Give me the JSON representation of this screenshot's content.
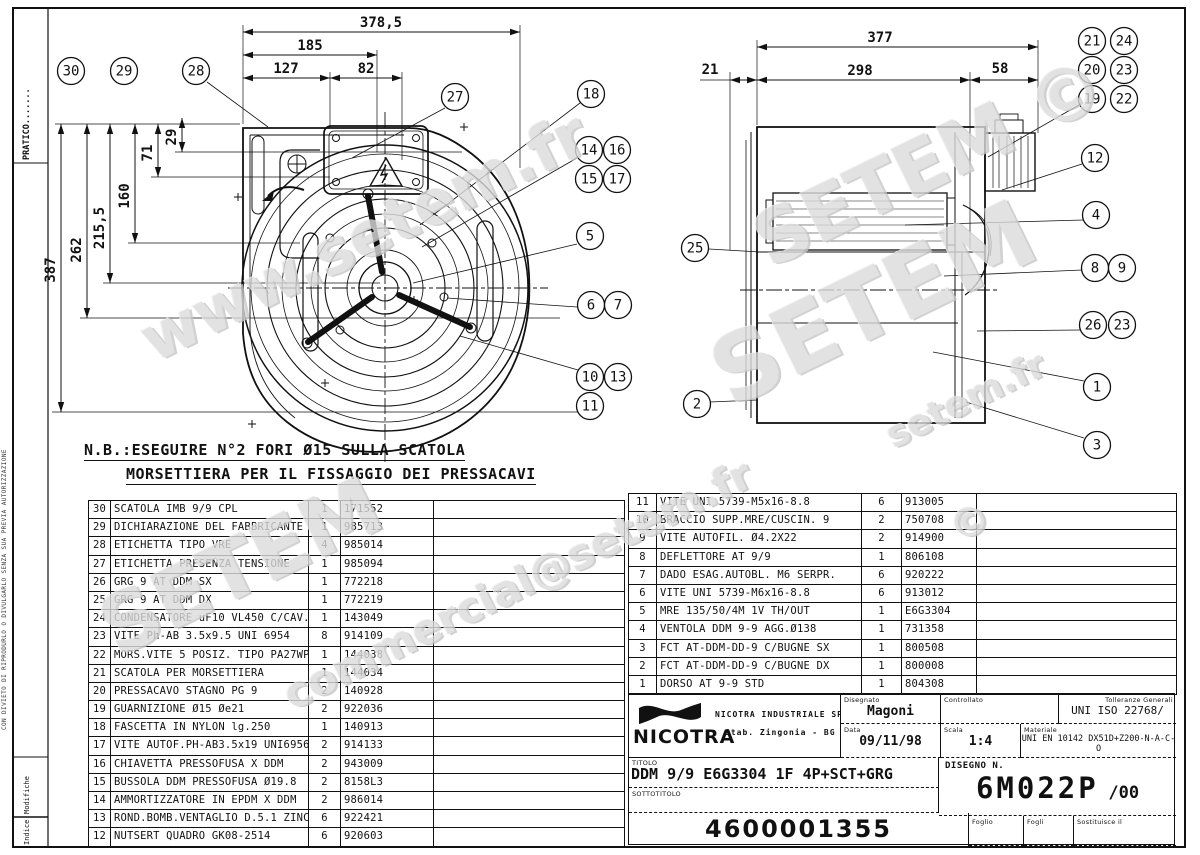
{
  "note": {
    "line1": "N.B.:ESEGUIRE N°2 FORI Ø15 SULLA SCATOLA",
    "line2": "MORSETTIERA PER IL FISSAGGIO DEI PRESSACAVI"
  },
  "margin": {
    "pratico": "PRATICO.......",
    "copyright": "CON DIVIETO DI RIPRODURLO O DIVULGARLO SENZA SUA PREVIA AUTORIZZAZIONE",
    "modifiche": "Modifiche",
    "indice": "Indice"
  },
  "dims": {
    "front_total": "378,5",
    "front_a": "185",
    "front_b": "127",
    "front_c": "82",
    "front_h_total": "387",
    "front_h1": "262",
    "front_h2": "215,5",
    "front_h3": "160",
    "front_h4": "71",
    "front_h5": "29",
    "side_total": "377",
    "side_a": "298",
    "side_b": "58",
    "side_c": "21"
  },
  "balloons": [
    "30",
    "29",
    "28",
    "27",
    "18",
    "14",
    "16",
    "15",
    "17",
    "5",
    "6",
    "7",
    "10",
    "13",
    "11",
    "21",
    "24",
    "20",
    "23",
    "19",
    "22",
    "12",
    "4",
    "8",
    "9",
    "26",
    "23",
    "1",
    "3",
    "25",
    "2"
  ],
  "parts_left": {
    "rows": [
      {
        "no": "30",
        "desc": "SCATOLA IMB 9/9 CPL",
        "qty": "1",
        "code": "171552"
      },
      {
        "no": "29",
        "desc": "DICHIARAZIONE DEL FABBRICANTE",
        "qty": "1",
        "code": "985713"
      },
      {
        "no": "28",
        "desc": "ETICHETTA TIPO VRE",
        "qty": "4",
        "code": "985014"
      },
      {
        "no": "27",
        "desc": "ETICHETTA PRESENZA TENSIONE",
        "qty": "1",
        "code": "985094"
      },
      {
        "no": "26",
        "desc": "GRG 9 AT DDM SX",
        "qty": "1",
        "code": "772218"
      },
      {
        "no": "25",
        "desc": "GRG 9 AT DDM DX",
        "qty": "1",
        "code": "772219"
      },
      {
        "no": "24",
        "desc": "CONDENSATORE uF10 VL450 C/CAV.",
        "qty": "1",
        "code": "143049"
      },
      {
        "no": "23",
        "desc": "VITE Ph-AB 3.5x9.5 UNI 6954",
        "qty": "8",
        "code": "914109"
      },
      {
        "no": "22",
        "desc": "MORS.VITE 5 POSIZ. TIPO PA27WP",
        "qty": "1",
        "code": "144038"
      },
      {
        "no": "21",
        "desc": "SCATOLA PER MORSETTIERA",
        "qty": "1",
        "code": "144034"
      },
      {
        "no": "20",
        "desc": "PRESSACAVO STAGNO PG 9",
        "qty": "2",
        "code": "140928"
      },
      {
        "no": "19",
        "desc": "GUARNIZIONE Ø15 Øe21",
        "qty": "2",
        "code": "922036"
      },
      {
        "no": "18",
        "desc": "FASCETTA IN NYLON lg.250",
        "qty": "1",
        "code": "140913"
      },
      {
        "no": "17",
        "desc": "VITE AUTOF.PH-AB3.5x19 UNI6956",
        "qty": "2",
        "code": "914133"
      },
      {
        "no": "16",
        "desc": "CHIAVETTA PRESSOFUSA X DDM",
        "qty": "2",
        "code": "943009"
      },
      {
        "no": "15",
        "desc": "BUSSOLA DDM PRESSOFUSA Ø19.8",
        "qty": "2",
        "code": "8158L3"
      },
      {
        "no": "14",
        "desc": "AMMORTIZZATORE IN EPDM X DDM",
        "qty": "2",
        "code": "986014"
      },
      {
        "no": "13",
        "desc": "ROND.BOMB.VENTAGLIO D.5.1 ZINC",
        "qty": "6",
        "code": "922421"
      },
      {
        "no": "12",
        "desc": "NUTSERT QUADRO GK08-2514",
        "qty": "6",
        "code": "920603"
      }
    ]
  },
  "parts_right": {
    "rows": [
      {
        "no": "11",
        "desc": "VITE UNI 5739-M5x16-8.8",
        "qty": "6",
        "code": "913005"
      },
      {
        "no": "10",
        "desc": "BRACCIO SUPP.MRE/CUSCIN. 9",
        "qty": "2",
        "code": "750708"
      },
      {
        "no": "9",
        "desc": "VITE AUTOFIL. Ø4.2X22",
        "qty": "2",
        "code": "914900"
      },
      {
        "no": "8",
        "desc": "DEFLETTORE AT 9/9",
        "qty": "1",
        "code": "806108"
      },
      {
        "no": "7",
        "desc": "DADO ESAG.AUTOBL. M6 SERPR.",
        "qty": "6",
        "code": "920222"
      },
      {
        "no": "6",
        "desc": "VITE UNI 5739-M6x16-8.8",
        "qty": "6",
        "code": "913012"
      },
      {
        "no": "5",
        "desc": "MRE 135/50/4M 1V TH/OUT",
        "qty": "1",
        "code": "E6G3304"
      },
      {
        "no": "4",
        "desc": "VENTOLA DDM 9-9 AGG.Ø138",
        "qty": "1",
        "code": "731358"
      },
      {
        "no": "3",
        "desc": "FCT AT-DDM-DD-9 C/BUGNE SX",
        "qty": "1",
        "code": "800508"
      },
      {
        "no": "2",
        "desc": "FCT AT-DDM-DD-9 C/BUGNE DX",
        "qty": "1",
        "code": "800008"
      },
      {
        "no": "1",
        "desc": "DORSO AT 9-9 STD",
        "qty": "1",
        "code": "804308"
      }
    ]
  },
  "title_block": {
    "company": "NICOTRA",
    "company_full": "NICOTRA INDUSTRIALE SPA",
    "plant": "Stab. Zingonia - BG",
    "labels": {
      "disegnato": "Disegnato",
      "controllato": "Controllato",
      "tolleranze": "Tolleranze Generali",
      "data": "Data",
      "scala": "Scala",
      "materiale": "Materiale",
      "titolo": "TITOLO",
      "sottotitolo": "SOTTOTITOLO",
      "disegno_n": "DISEGNO N.",
      "foglio": "Foglio",
      "fogli": "Fogli",
      "sostituisce": "Sostituisce il"
    },
    "values": {
      "disegnato": "Magoni",
      "data": "09/11/98",
      "scala": "1:4",
      "tolleranze": "UNI ISO 22768/",
      "materiale": "UNI EN 10142 DX51D+Z200-N-A-C-O",
      "titolo": "DDM 9/9 E6G3304 1F 4P+SCT+GRG",
      "disegno_n": "6M022P",
      "revision": "/00",
      "part_number": "4600001355"
    }
  },
  "watermarks": {
    "w1": "www.setem.fr",
    "w2": "SETEM ©",
    "w3": "SETEM",
    "w4": "SETEM",
    "w5": "commercial@setem.fr",
    "w6": "setem.fr",
    "w7": "©"
  },
  "colors": {
    "line": "#111111",
    "watermark": "#dcdcdc",
    "background": "#ffffff"
  }
}
